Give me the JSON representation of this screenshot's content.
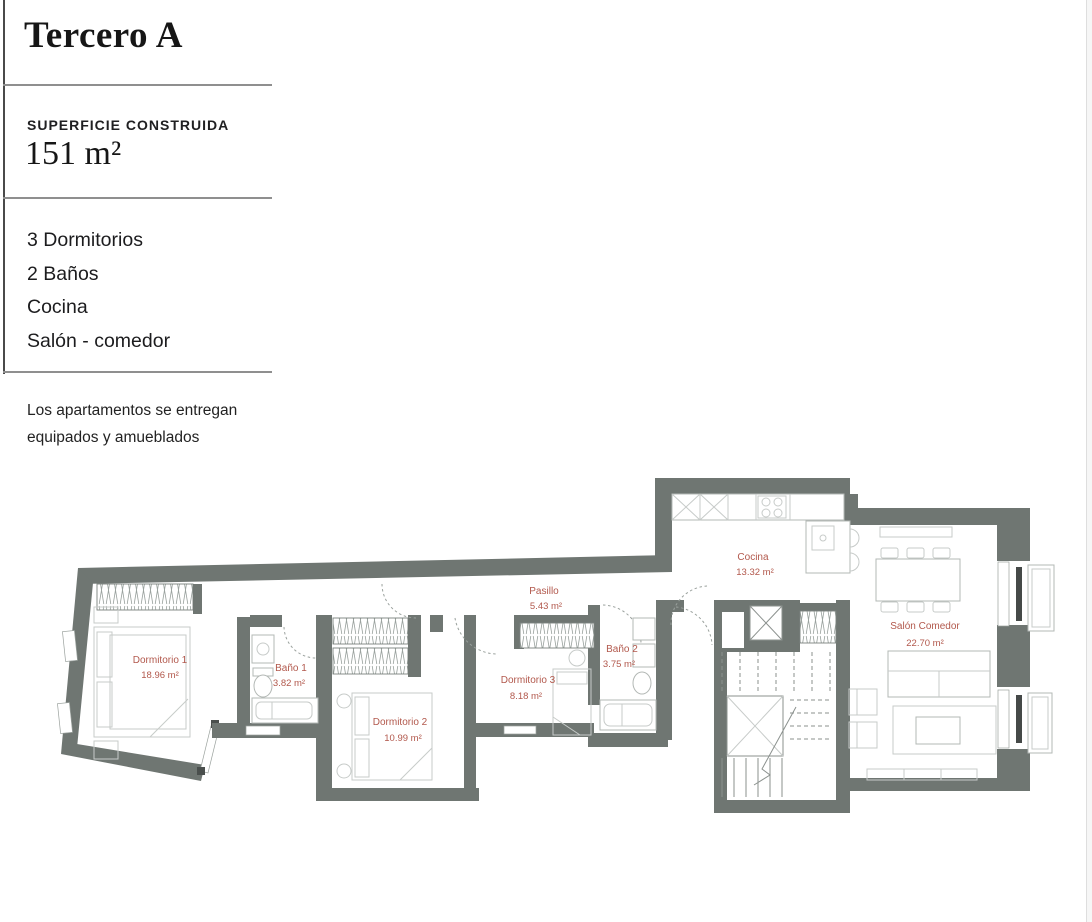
{
  "header": {
    "title": "Tercero A",
    "surface_label": "SUPERFICIE CONSTRUIDA",
    "surface_value": "151 m²",
    "features": [
      "3 Dormitorios",
      "2 Baños",
      "Cocina",
      "Salón - comedor"
    ],
    "note_lines": [
      "Los apartamentos se entregan",
      "equipados y amueblados"
    ]
  },
  "floorplan": {
    "rooms": [
      {
        "name": "Dormitorio 1",
        "area": "18.96 m²"
      },
      {
        "name": "Baño 1",
        "area": "3.82 m²"
      },
      {
        "name": "Dormitorio 2",
        "area": "10.99 m²"
      },
      {
        "name": "Dormitorio 3",
        "area": "8.18 m²"
      },
      {
        "name": "Pasillo",
        "area": "5.43 m²"
      },
      {
        "name": "Baño 2",
        "area": "3.75 m²"
      },
      {
        "name": "Cocina",
        "area": "13.32 m²"
      },
      {
        "name": "Salón Comedor",
        "area": "22.70 m²"
      }
    ]
  },
  "colors": {
    "wall": "#6f7672",
    "room_label": "#b2584c",
    "text": "#1c1c1e",
    "divider": "#8f8f8f"
  }
}
